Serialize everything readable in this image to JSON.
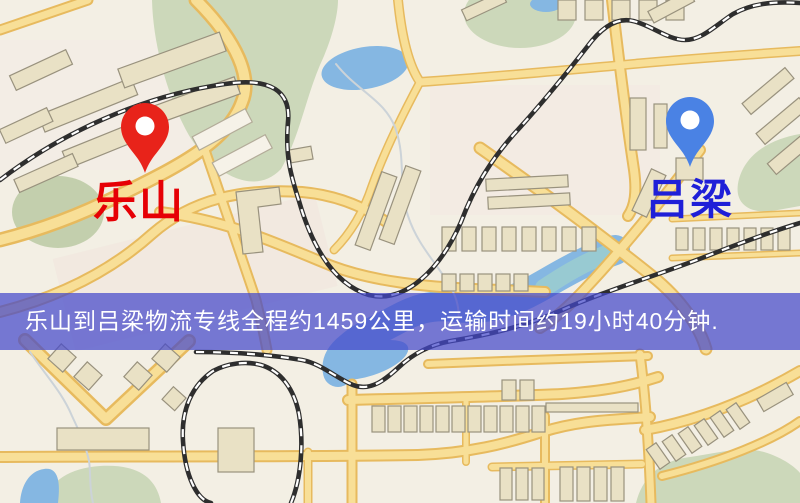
{
  "banner": {
    "text": "乐山到吕梁物流专线全程约1459公里，运输时间约19小时40分钟.",
    "background_color": "rgba(68,72,203,0.72)",
    "text_color": "#ffffff",
    "distance_km": "1459",
    "duration_text": "19小时40分钟"
  },
  "pins": {
    "origin": {
      "label": "乐山",
      "pin_color": "#e8231a",
      "label_color": "#e60005"
    },
    "destination": {
      "label": "吕梁",
      "pin_color": "#4a82e4",
      "label_color": "#1f1fd8"
    }
  },
  "map_palette": {
    "background": "#f3efe4",
    "road_fill": "#f8df97",
    "road_casing": "#e7ba5e",
    "building_fill": "#e9e1c5",
    "park_green": "#ccd8ba",
    "water_blue": "#85b7e2",
    "railway_dark": "#2e2e2e"
  }
}
